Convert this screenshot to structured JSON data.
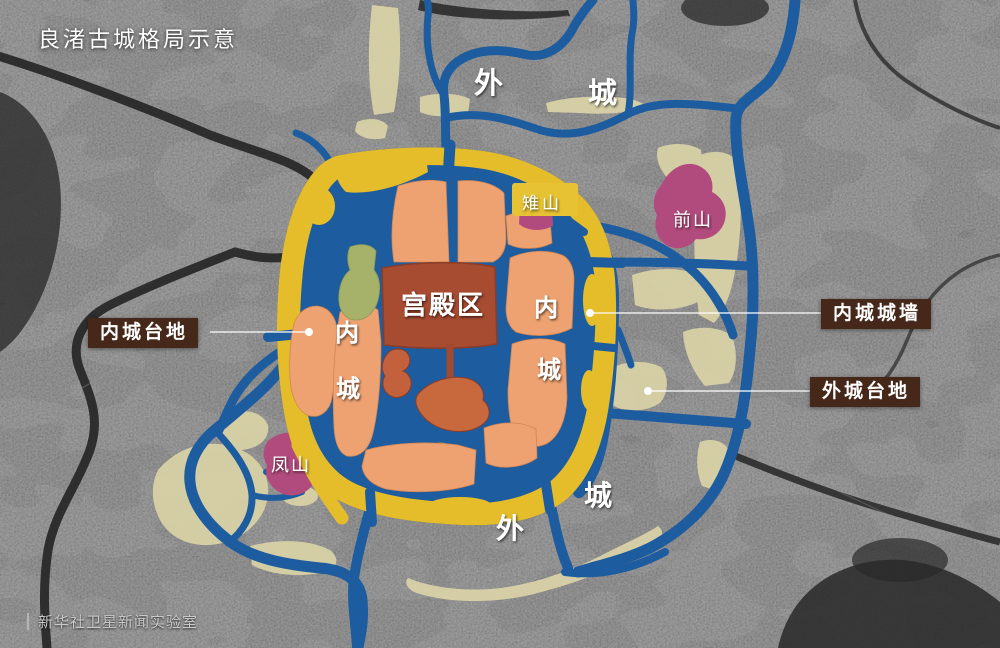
{
  "title": "良渚古城格局示意",
  "credit": {
    "text": "新华社卫星新闻实验室"
  },
  "map_labels": {
    "outer_city_top": [
      "外",
      "城"
    ],
    "outer_city_bottom": [
      "外",
      "城"
    ],
    "inner_city_left": [
      "内",
      "城"
    ],
    "inner_city_right": [
      "内",
      "城"
    ],
    "palace": "宫殿区",
    "zhishan": "雉山",
    "qianshan": "前山",
    "fengshan": "凤山"
  },
  "callouts": {
    "inner_city_platform": "内城台地",
    "inner_city_wall": "内城城墙",
    "outer_city_platform": "外城台地"
  },
  "colors": {
    "water": "#1d5c9f",
    "city_wall": "#e5bd2b",
    "inner_platform": "#efa271",
    "palace": "#a74b31",
    "palace_mound": "#c8693d",
    "green_terrace": "#a6b269",
    "mountain": "#b24b7d",
    "outer_platform": "#dad3a7",
    "callout_background": "#46281a",
    "satellite_ground": "#454545"
  }
}
